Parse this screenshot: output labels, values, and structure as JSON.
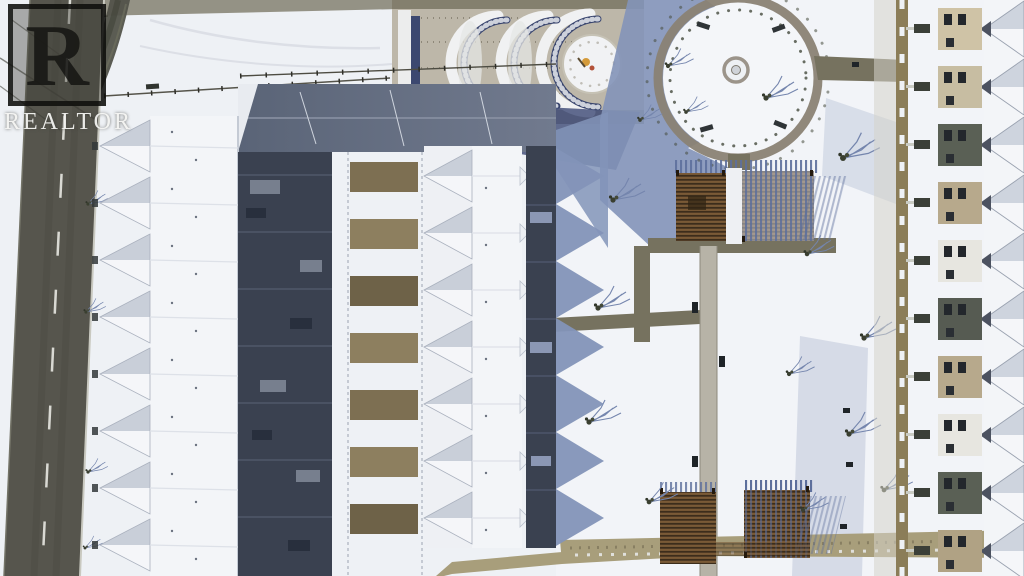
{
  "watermark": {
    "letter": "R",
    "label": "REALTOR"
  },
  "scene": {
    "kind": "aerial-photograph",
    "subject": "winter aerial view of a snow-covered townhouse complex with a central linear park",
    "elements": [
      "left-road",
      "left-townhouse-row",
      "central-townhouse-row",
      "right-townhouse-row",
      "circular-plaza",
      "fountain",
      "crescent-terrace-garden",
      "north-pergola",
      "south-pergola",
      "park-paths",
      "bare-trees",
      "building-shadows"
    ]
  },
  "palette": {
    "snow": "#eef1f5",
    "snowBright": "#f5f7fa",
    "shadowBlue": "#8394b8",
    "shadowNavy": "#46527c",
    "road": "#56554d",
    "roadLine": "#e8e8e2",
    "pathOlive": "#76725f",
    "pathTan": "#a89e7b",
    "pathLight": "#b7b3a7",
    "ringPath": "#8a8274",
    "darkYard": "#3a4150",
    "woodBrown": "#7a5a36",
    "stone": "#b7a98c",
    "treeDark": "#3a3f30"
  }
}
